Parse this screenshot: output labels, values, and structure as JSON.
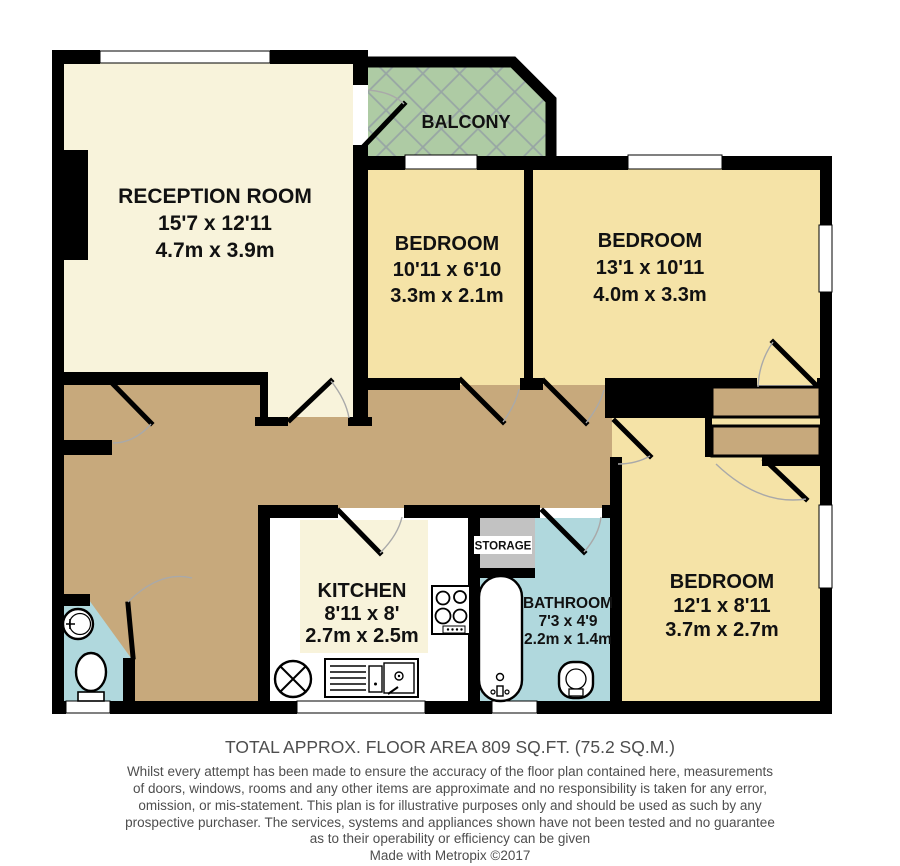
{
  "plan": {
    "rooms": {
      "reception": {
        "name": "RECEPTION ROOM",
        "imperial": "15'7 x 12'11",
        "metric": "4.7m x 3.9m"
      },
      "balcony": {
        "name": "BALCONY"
      },
      "bedroom1": {
        "name": "BEDROOM",
        "imperial": "10'11 x 6'10",
        "metric": "3.3m x 2.1m"
      },
      "bedroom2": {
        "name": "BEDROOM",
        "imperial": "13'1 x 10'11",
        "metric": "4.0m x 3.3m"
      },
      "bedroom3": {
        "name": "BEDROOM",
        "imperial": "12'1 x 8'11",
        "metric": "3.7m x 2.7m"
      },
      "kitchen": {
        "name": "KITCHEN",
        "imperial": "8'11 x 8'",
        "metric": "2.7m x 2.5m"
      },
      "bathroom": {
        "name": "BATHROOM",
        "imperial": "7'3 x 4'9",
        "metric": "2.2m x 1.4m"
      },
      "storage": {
        "name": "STORAGE"
      }
    },
    "colors": {
      "reception_floor": "#F8F3DB",
      "bedroom_floor": "#F5E3A7",
      "hallway_floor": "#C7A97C",
      "balcony_floor": "#AECBA4",
      "bathroom_floor": "#B0D8DD",
      "storage_floor": "#C2C2C2",
      "wall": "#000000",
      "window": "#FFFFFF",
      "footer_text": "#4E4E4E"
    }
  },
  "footer": {
    "total_area": "TOTAL APPROX. FLOOR AREA 809 SQ.FT. (75.2 SQ.M.)",
    "disclaimer_lines": [
      "Whilst every attempt has been made to ensure the accuracy of the floor plan contained here, measurements",
      "of doors, windows, rooms and any other items are approximate and no responsibility is taken for any error,",
      "omission, or mis-statement. This plan is for illustrative purposes only and should be used as such by any",
      "prospective purchaser. The services, systems and appliances shown have not been tested and no guarantee",
      "as to their operability or efficiency can be given"
    ],
    "credit": "Made with Metropix ©2017"
  }
}
